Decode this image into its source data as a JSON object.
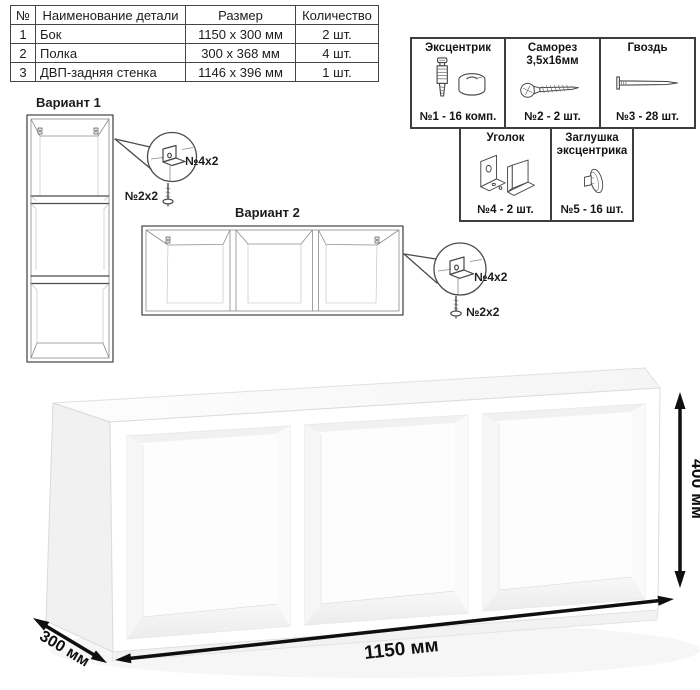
{
  "ink": {
    "line_color": "#4a4a4a",
    "text_color": "#1c1c1c",
    "dimension_color": "#0f0f0f",
    "border_color": "#3e3e3e"
  },
  "parts_table": {
    "headers": [
      "№",
      "Наименование детали",
      "Размер",
      "Количество"
    ],
    "rows": [
      {
        "num": "1",
        "name": "Бок",
        "size": "1150 x 300 мм",
        "qty": "2 шт."
      },
      {
        "num": "2",
        "name": "Полка",
        "size": "300 x 368 мм",
        "qty": "4 шт."
      },
      {
        "num": "3",
        "name": "ДВП-задняя стенка",
        "size": "1146 x 396 мм",
        "qty": "1 шт."
      }
    ]
  },
  "hardware": {
    "items": [
      {
        "title": "Эксцентрик",
        "qty": "№1 - 16 комп.",
        "icon": "cam-lock-icon"
      },
      {
        "title": "Саморез 3,5х16мм",
        "qty": "№2 - 2 шт.",
        "icon": "screw-icon"
      },
      {
        "title": "Гвоздь",
        "qty": "№3 - 28 шт.",
        "icon": "nail-icon"
      },
      {
        "title": "Уголок",
        "qty": "№4 - 2 шт.",
        "icon": "corner-bracket-icon"
      },
      {
        "title": "Заглушка эксцентрика",
        "qty": "№5 - 16 шт.",
        "icon": "cam-cap-icon"
      }
    ]
  },
  "variants": {
    "variant1": {
      "title": "Вариант 1",
      "bracket_label": "№4х2",
      "screw_label": "№2х2"
    },
    "variant2": {
      "title": "Вариант 2",
      "bracket_label": "№4х2",
      "screw_label": "№2х2"
    }
  },
  "dimensions": {
    "width": "1150 мм",
    "depth": "300 мм",
    "height": "400 мм"
  }
}
